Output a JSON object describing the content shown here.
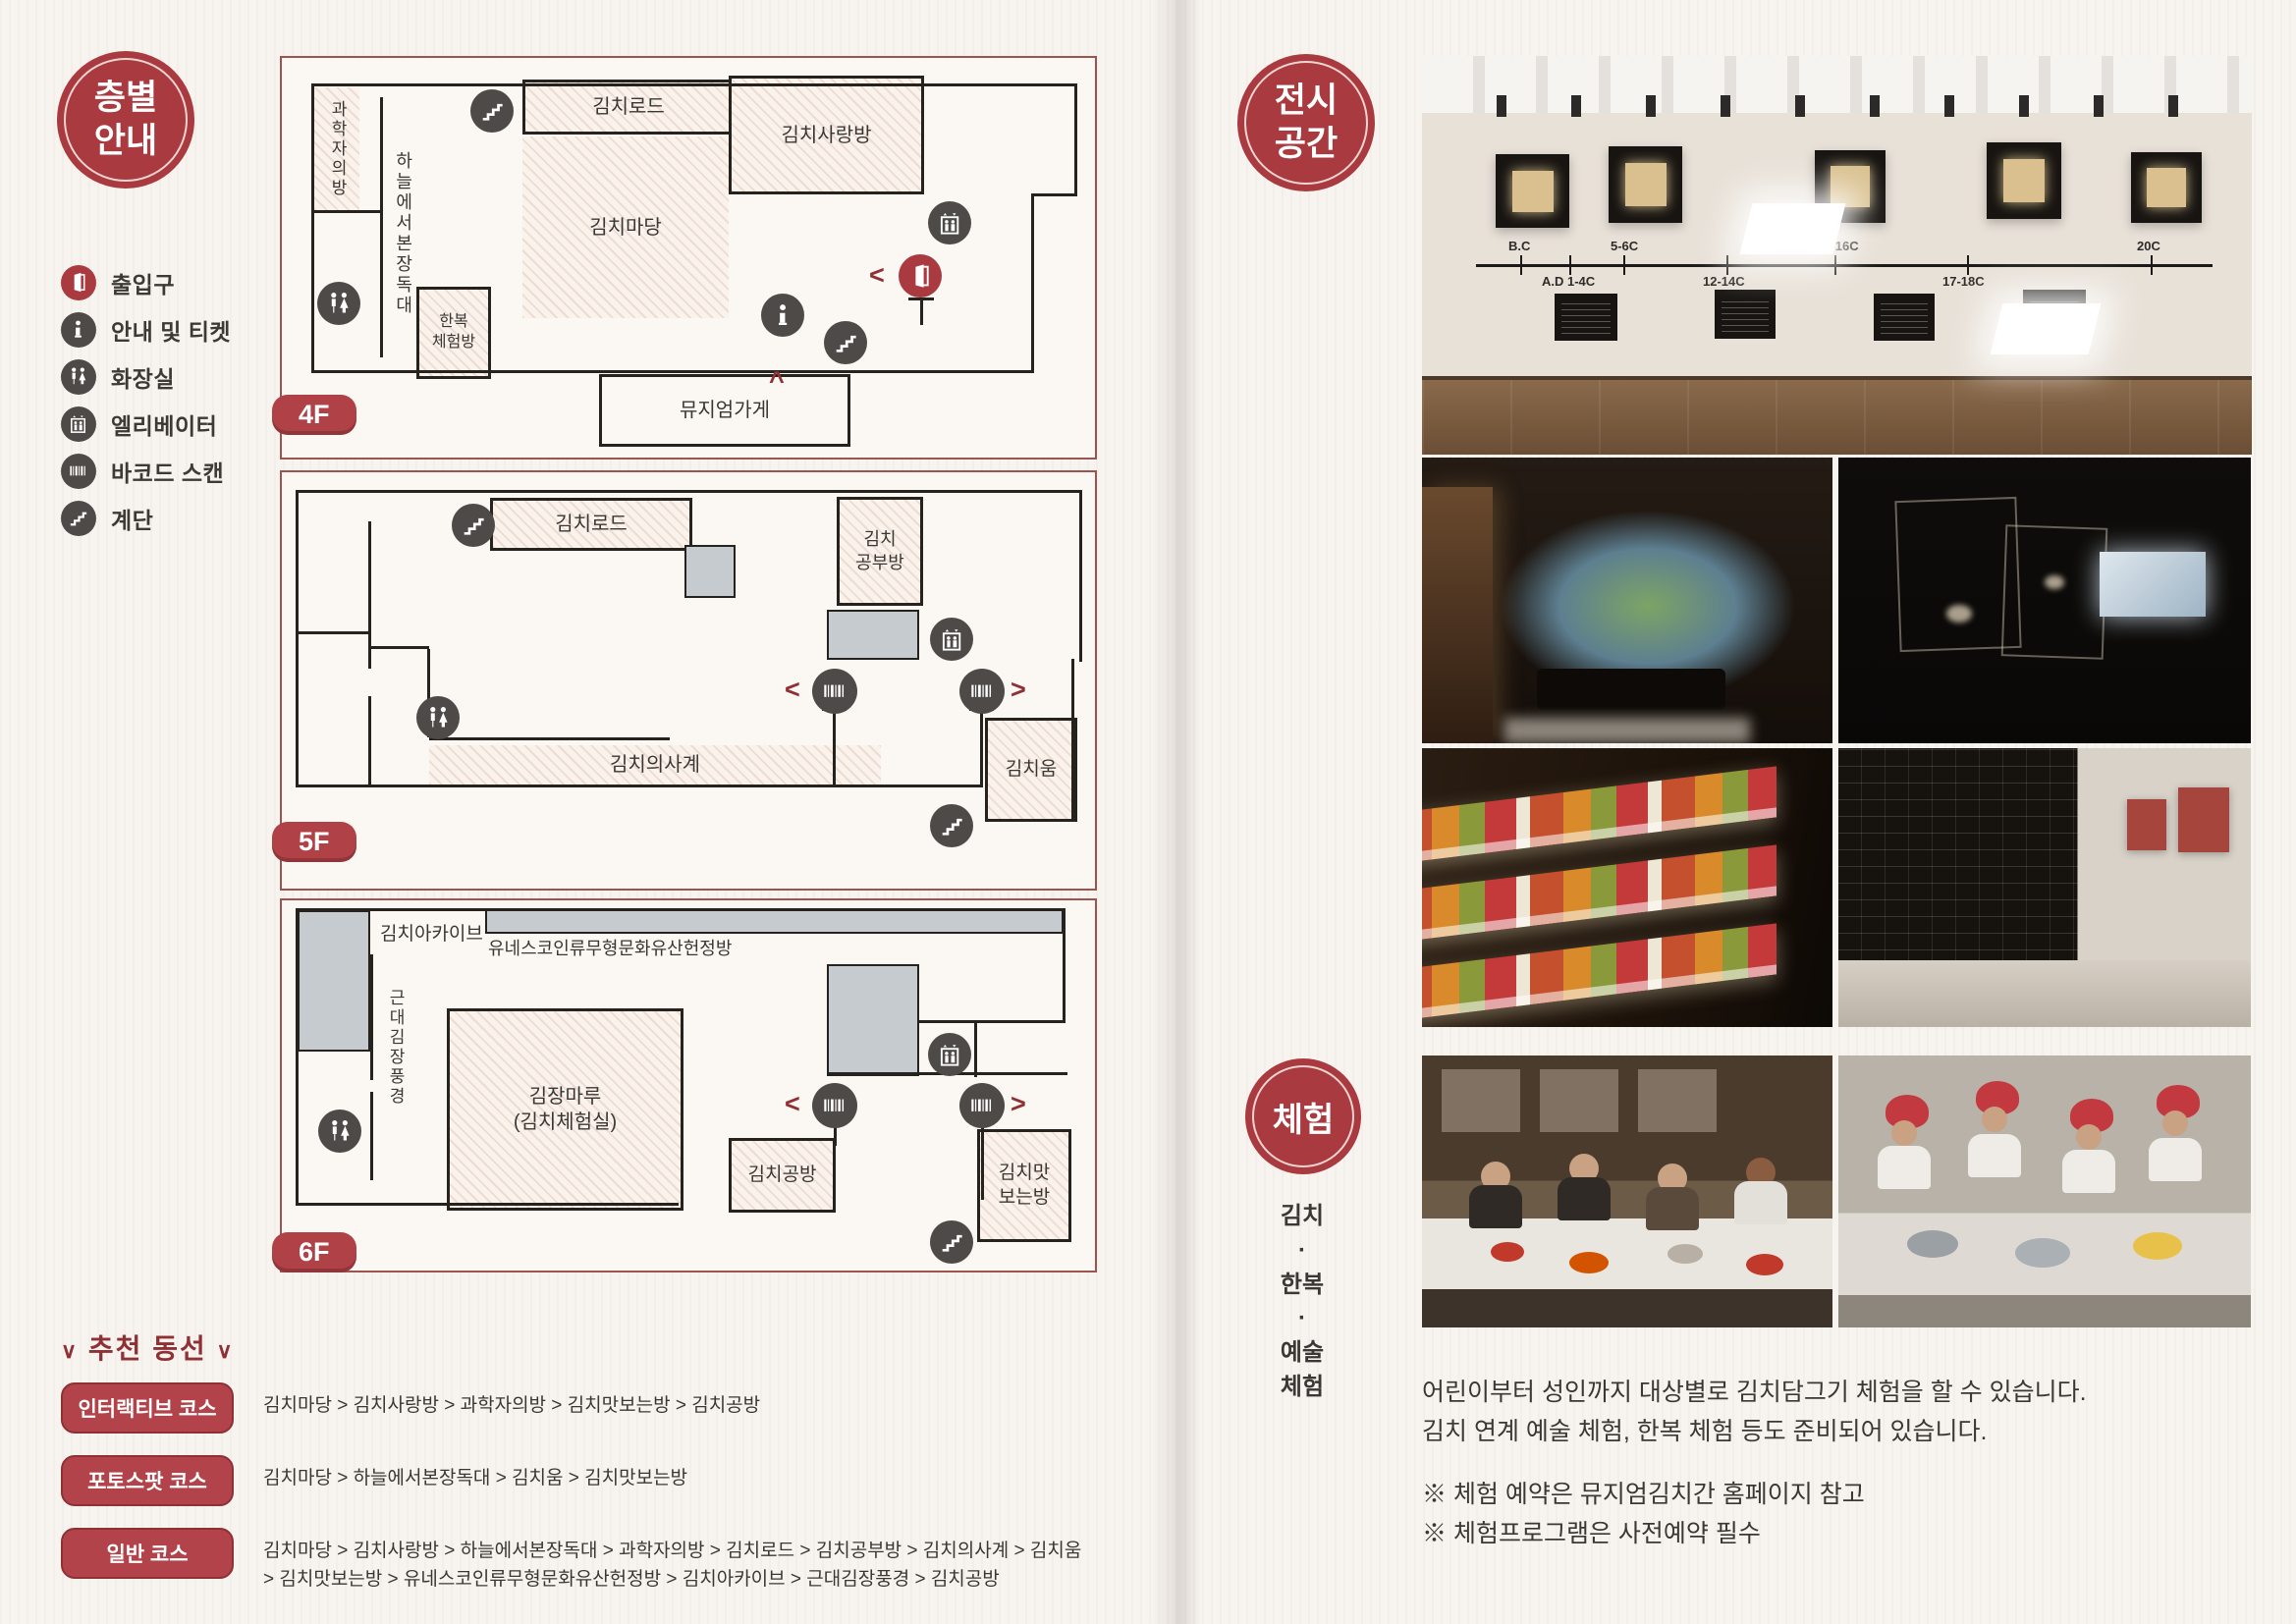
{
  "left": {
    "badge_label": "층별\n안내",
    "legend": [
      {
        "icon": "entrance-icon",
        "label": "출입구"
      },
      {
        "icon": "info-ticket-icon",
        "label": "안내 및 티켓"
      },
      {
        "icon": "restroom-icon",
        "label": "화장실"
      },
      {
        "icon": "elevator-icon",
        "label": "엘리베이터"
      },
      {
        "icon": "barcode-scan-icon",
        "label": "바코드 스캔"
      },
      {
        "icon": "stairs-icon",
        "label": "계단"
      }
    ],
    "floor4": {
      "tag": "4F",
      "science_room": "과학자의방",
      "sky_jangdokdae": "하늘에서본장독대",
      "kimchi_road": "김치로드",
      "kimchi_sarangbang": "김치사랑방",
      "kimchi_madang": "김치마당",
      "hanbok_room": "한복\n체험방",
      "museum_shop": "뮤지엄가게"
    },
    "floor5": {
      "tag": "5F",
      "kimchi_road": "김치로드",
      "kimchi_study_room": "김치\n공부방",
      "kimchi_four_seasons": "김치의사계",
      "kimchi_um": "김치움"
    },
    "floor6": {
      "tag": "6F",
      "kimchi_archive": "김치아카이브",
      "unesco_room": "유네스코인류무형문화유산헌정방",
      "modern_kimjang": "근대김장풍경",
      "kimjang_maru": "김장마루\n(김치체험실)",
      "kimchi_gongbang": "김치공방",
      "kimchi_tasting_room": "김치맛\n보는방"
    },
    "courses": {
      "deco": "∨",
      "title": "추천 동선",
      "items": [
        {
          "name": "인터랙티브 코스",
          "route": "김치마당 > 김치사랑방 > 과학자의방 > 김치맛보는방 > 김치공방"
        },
        {
          "name": "포토스팟 코스",
          "route": "김치마당 > 하늘에서본장독대 > 김치움 > 김치맛보는방"
        },
        {
          "name": "일반 코스",
          "route": "김치마당 > 김치사랑방 > 하늘에서본장독대 > 과학자의방 > 김치로드 > 김치공부방 > 김치의사계 > 김치움 > 김치맛보는방 > 유네스코인류무형문화유산헌정방 > 김치아카이브 > 근대김장풍경 > 김치공방"
        }
      ]
    }
  },
  "right": {
    "exhibition_badge_label": "전시\n공간",
    "timeline": [
      "B.C",
      "5-6C",
      "15-16C",
      "20C",
      "A.D 1-4C",
      "12-14C",
      "17-18C"
    ],
    "experience_badge_label": "체험",
    "experience_side_label": "김치\n·\n한복\n·\n예술\n체험",
    "experience_description": "어린이부터 성인까지 대상별로 김치담그기 체험을 할 수 있습니다.\n김치 연계 예술 체험, 한복 체험 등도 준비되어 있습니다.",
    "experience_notes": "※ 체험 예약은 뮤지엄김치간 홈페이지 참고\n※ 체험프로그램은 사전예약 필수"
  },
  "colors": {
    "accent_red": "#a93b40",
    "icon_gray": "#4d4a47",
    "paper": "#f7f4f0"
  }
}
